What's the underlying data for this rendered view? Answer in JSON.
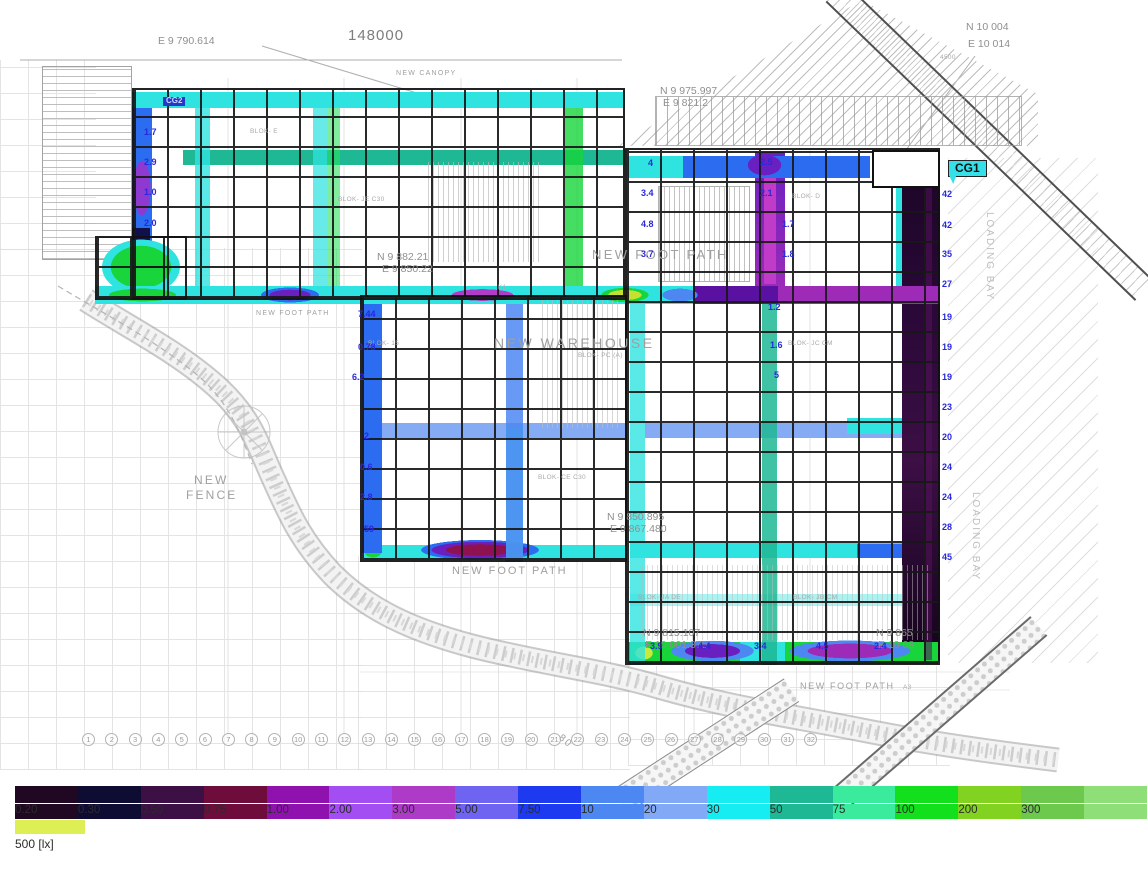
{
  "plan": {
    "dim_148000": "148000",
    "cg1": "CG1",
    "cg2": "CG2",
    "coordinate_labels": [
      {
        "t": "E 9 790.614",
        "x": 158,
        "y": 36
      },
      {
        "t": "N 10 004",
        "x": 966,
        "y": 22
      },
      {
        "t": "E 10 014",
        "x": 968,
        "y": 39
      },
      {
        "t": "N 9 975.997",
        "x": 660,
        "y": 86
      },
      {
        "t": "E 9 821.2",
        "x": 663,
        "y": 98
      },
      {
        "t": "N 9 882.21",
        "x": 377,
        "y": 252
      },
      {
        "t": "E 9 850.22",
        "x": 382,
        "y": 264
      },
      {
        "t": "N 9 850.895",
        "x": 607,
        "y": 512
      },
      {
        "t": "E 9 867.480",
        "x": 610,
        "y": 524
      },
      {
        "t": "N 9 815.107",
        "x": 643,
        "y": 628
      },
      {
        "t": "E 10 001.375",
        "x": 645,
        "y": 640
      },
      {
        "t": "N 9 865",
        "x": 876,
        "y": 628
      },
      {
        "t": "E 10 08",
        "x": 878,
        "y": 640
      }
    ],
    "area_labels": [
      {
        "t": "NEW CANOPY",
        "x": 396,
        "y": 70,
        "s": 7
      },
      {
        "t": "NEW FOOT PATH",
        "x": 592,
        "y": 248,
        "s": 13
      },
      {
        "t": "NEW FOOT PATH",
        "x": 256,
        "y": 310,
        "s": 7
      },
      {
        "t": "NEW FOOT PATH",
        "x": 452,
        "y": 565,
        "s": 11
      },
      {
        "t": "NEW FOOT PATH",
        "x": 800,
        "y": 682,
        "s": 9
      },
      {
        "t": "NEW",
        "x": 194,
        "y": 474,
        "s": 12
      },
      {
        "t": "FENCE",
        "x": 186,
        "y": 489,
        "s": 12
      },
      {
        "t": "NEW WAREHOUSE",
        "x": 494,
        "y": 336,
        "s": 14
      },
      {
        "t": "80",
        "x": 558,
        "y": 736,
        "s": 10,
        "rot": 40
      }
    ],
    "tiny_labels": [
      {
        "t": "4500",
        "x": 940,
        "y": 54
      },
      {
        "t": "BLOK- E",
        "x": 250,
        "y": 128
      },
      {
        "t": "BLOK- JE C30",
        "x": 338,
        "y": 196
      },
      {
        "t": "BLOK- D",
        "x": 792,
        "y": 193
      },
      {
        "t": "BLOK- 15",
        "x": 368,
        "y": 340
      },
      {
        "t": "BLOK- PC (A)",
        "x": 578,
        "y": 352
      },
      {
        "t": "BLOK- JC CM",
        "x": 788,
        "y": 340
      },
      {
        "t": "BLOK- CE C30",
        "x": 538,
        "y": 474
      },
      {
        "t": "BLOK- JA DE",
        "x": 638,
        "y": 594
      },
      {
        "t": "BLOK- JB CM",
        "x": 793,
        "y": 594
      },
      {
        "t": "K1",
        "x": 498,
        "y": 284
      },
      {
        "t": "A3",
        "x": 903,
        "y": 684
      }
    ],
    "lux_values": [
      {
        "t": "1.7",
        "x": 144,
        "y": 128
      },
      {
        "t": "2.9",
        "x": 144,
        "y": 158
      },
      {
        "t": "1.0",
        "x": 144,
        "y": 188
      },
      {
        "t": "2.0",
        "x": 144,
        "y": 219
      },
      {
        "t": "4",
        "x": 648,
        "y": 159
      },
      {
        "t": "3.4",
        "x": 641,
        "y": 189
      },
      {
        "t": "4.8",
        "x": 641,
        "y": 220
      },
      {
        "t": "3.7",
        "x": 641,
        "y": 250
      },
      {
        "t": "2.5",
        "x": 760,
        "y": 158
      },
      {
        "t": "2.1",
        "x": 760,
        "y": 189
      },
      {
        "t": "1.7",
        "x": 782,
        "y": 220
      },
      {
        "t": "1.8",
        "x": 782,
        "y": 250
      },
      {
        "t": "42",
        "x": 942,
        "y": 190
      },
      {
        "t": "42",
        "x": 942,
        "y": 221
      },
      {
        "t": "35",
        "x": 942,
        "y": 250
      },
      {
        "t": "27",
        "x": 942,
        "y": 280
      },
      {
        "t": "19",
        "x": 942,
        "y": 313
      },
      {
        "t": "19",
        "x": 942,
        "y": 343
      },
      {
        "t": "19",
        "x": 942,
        "y": 373
      },
      {
        "t": "23",
        "x": 942,
        "y": 403
      },
      {
        "t": "20",
        "x": 942,
        "y": 433
      },
      {
        "t": "24",
        "x": 942,
        "y": 463
      },
      {
        "t": "24",
        "x": 942,
        "y": 493
      },
      {
        "t": "28",
        "x": 942,
        "y": 523
      },
      {
        "t": "45",
        "x": 942,
        "y": 553
      },
      {
        "t": "7.44",
        "x": 358,
        "y": 310
      },
      {
        "t": "0.78",
        "x": 358,
        "y": 343
      },
      {
        "t": "6.2",
        "x": 352,
        "y": 373
      },
      {
        "t": "2",
        "x": 364,
        "y": 432
      },
      {
        "t": "0.6",
        "x": 360,
        "y": 463
      },
      {
        "t": "2.8",
        "x": 360,
        "y": 493
      },
      {
        "t": "59",
        "x": 364,
        "y": 525
      },
      {
        "t": "1.2",
        "x": 768,
        "y": 303
      },
      {
        "t": "1.6",
        "x": 770,
        "y": 341
      },
      {
        "t": "5",
        "x": 774,
        "y": 371
      },
      {
        "t": "3.9",
        "x": 650,
        "y": 642
      },
      {
        "t": "4.4",
        "x": 698,
        "y": 642
      },
      {
        "t": "3.4",
        "x": 754,
        "y": 642
      },
      {
        "t": "4.5",
        "x": 816,
        "y": 642
      },
      {
        "t": "2.4",
        "x": 874,
        "y": 642
      }
    ],
    "loading_bay_labels": [
      {
        "t": "LOADING BAY",
        "x": 984,
        "y": 212
      },
      {
        "t": "LOADING BAY",
        "x": 970,
        "y": 492
      }
    ],
    "grid_bubbles": [
      "1",
      "2",
      "3",
      "4",
      "5",
      "6",
      "7",
      "8",
      "9",
      "10",
      "11",
      "12",
      "13",
      "14",
      "15",
      "16",
      "17",
      "18",
      "19",
      "20",
      "21",
      "22",
      "23",
      "24",
      "25",
      "26",
      "27",
      "28",
      "29",
      "30",
      "31",
      "32"
    ]
  },
  "scale": {
    "segments": [
      {
        "label": "0.20",
        "color": "#200722"
      },
      {
        "label": "0.30",
        "color": "#0f0c33"
      },
      {
        "label": "0.50",
        "color": "#3c0f45"
      },
      {
        "label": "0.75",
        "color": "#6e0d3c"
      },
      {
        "label": "1.00",
        "color": "#9012ae"
      },
      {
        "label": "2.00",
        "color": "#a34ef2"
      },
      {
        "label": "3.00",
        "color": "#ad3bc8"
      },
      {
        "label": "5.00",
        "color": "#6f63f2"
      },
      {
        "label": "7.50",
        "color": "#1e3af0"
      },
      {
        "label": "10",
        "color": "#4d87f2"
      },
      {
        "label": "20",
        "color": "#82a9f5"
      },
      {
        "label": "30",
        "color": "#16edf2"
      },
      {
        "label": "50",
        "color": "#1eb894"
      },
      {
        "label": "75",
        "color": "#3aeb9e"
      },
      {
        "label": "100",
        "color": "#12e01c"
      },
      {
        "label": "200",
        "color": "#82d222"
      },
      {
        "label": "300",
        "color": "#6cc94e"
      },
      {
        "label": "",
        "color": "#8fdf78"
      }
    ],
    "legend_swatch": {
      "label": "500 [lx]",
      "color": "#ddef55"
    }
  },
  "colors": {
    "cg1_badge": "#35e0e8",
    "cg2_badge": "#2438c8",
    "lux_text": "#2828dc"
  }
}
